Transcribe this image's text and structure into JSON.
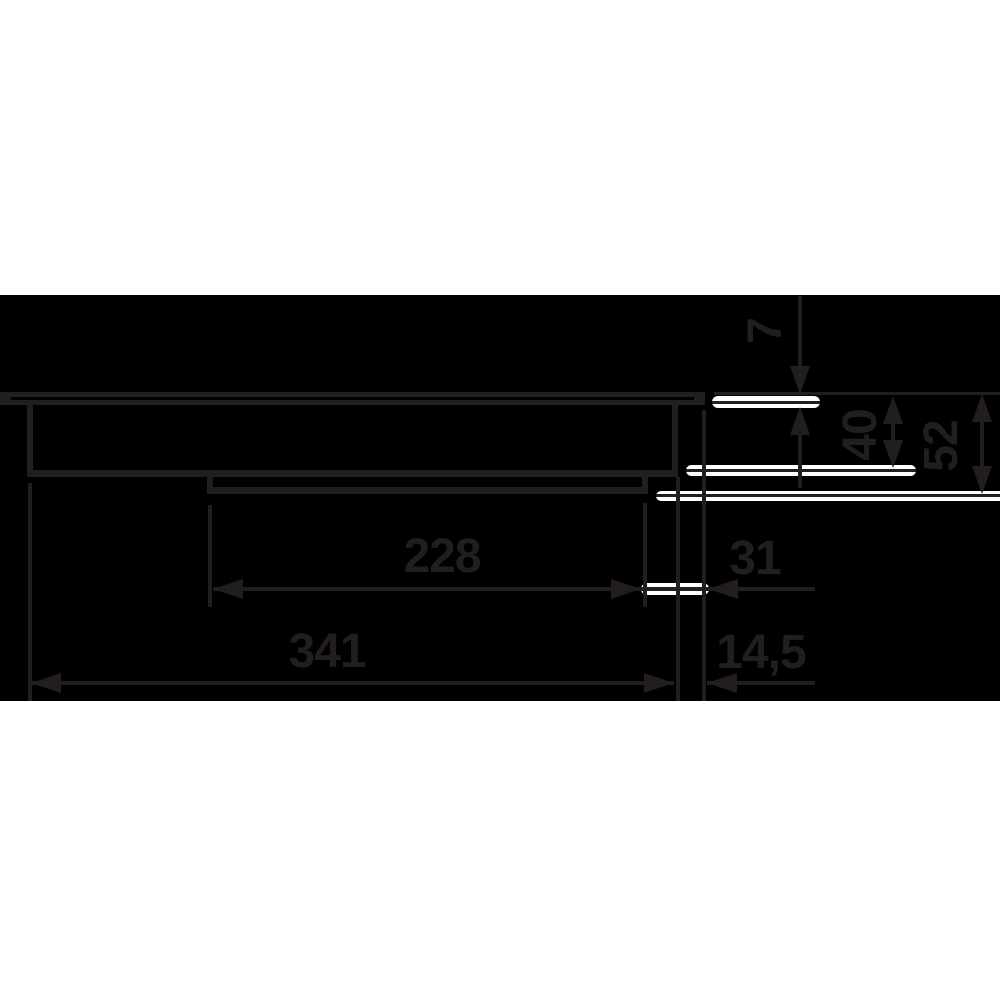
{
  "drawing": {
    "description": "Built-in hob side profile installation dimension drawing",
    "colors": {
      "canvas": "#ffffff",
      "panel": "#000000",
      "ink": "#221e1f",
      "highlight": "#ffffff"
    },
    "dimensions": [
      {
        "id": "glass-thickness",
        "value": "7",
        "orientation": "vertical"
      },
      {
        "id": "recess-depth",
        "value": "40",
        "orientation": "vertical"
      },
      {
        "id": "overall-depth",
        "value": "52",
        "orientation": "vertical"
      },
      {
        "id": "lower-box-width",
        "value": "228",
        "orientation": "horizontal"
      },
      {
        "id": "right-overhang",
        "value": "31",
        "orientation": "horizontal"
      },
      {
        "id": "overall-body-width",
        "value": "341",
        "orientation": "horizontal"
      },
      {
        "id": "edge-offset",
        "value": "14,5",
        "orientation": "horizontal"
      }
    ]
  }
}
